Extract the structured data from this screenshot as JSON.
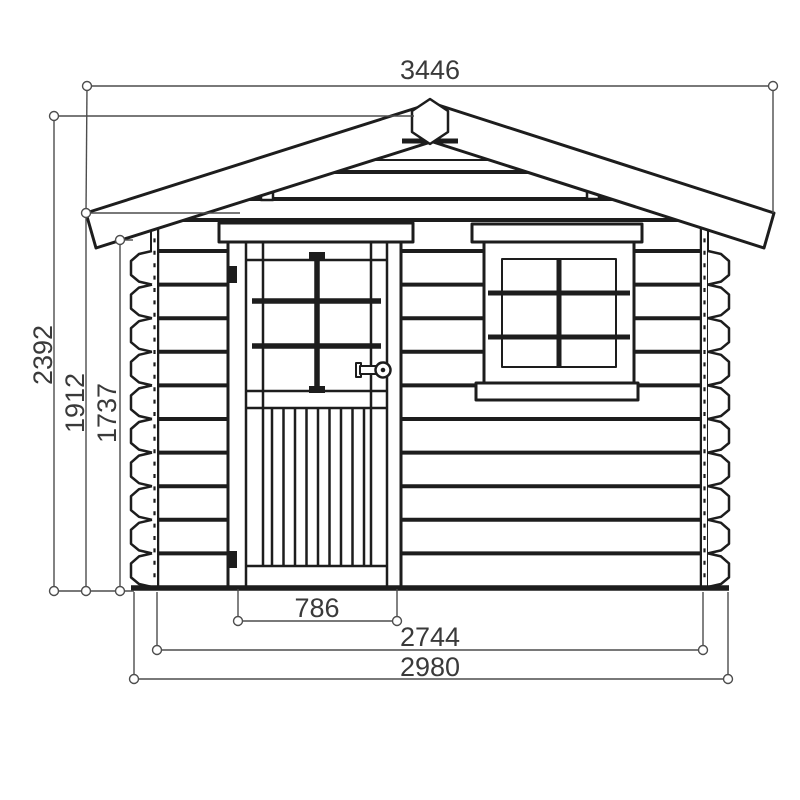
{
  "dimensions": {
    "roof_width": "3446",
    "overall_height": "2392",
    "wall_height": "1912",
    "door_height": "1737",
    "door_width": "786",
    "wall_length": "2744",
    "overall_width": "2980"
  },
  "colors": {
    "background": "#ffffff",
    "line": "#1d1d1d",
    "dimension_line": "#4d4d4d",
    "label_text": "#3a3a3a"
  }
}
